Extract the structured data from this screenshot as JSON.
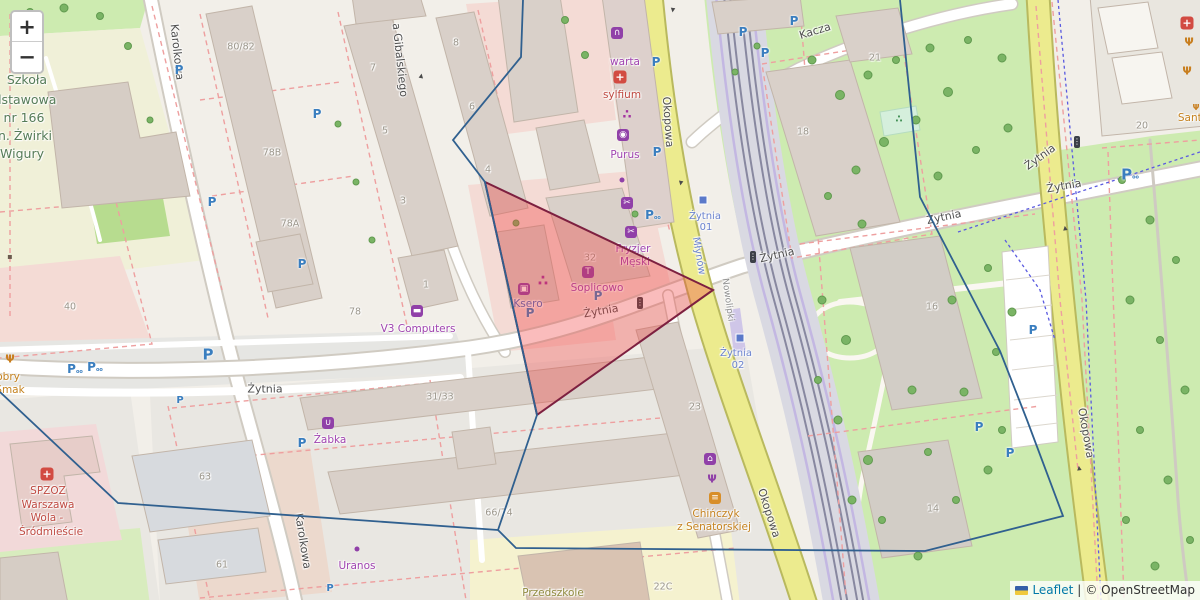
{
  "attribution": {
    "leaflet": "Leaflet",
    "separator": "|",
    "osm": "© OpenStreetMap"
  },
  "zoom_control": {
    "zoom_in": "+",
    "zoom_out": "−"
  },
  "colors": {
    "triangle_fill": "#ef3b3b",
    "triangle_stroke": "#7d2040",
    "boundary_stroke": "#30608f",
    "shop_purple": "#a044b0",
    "transit_blue": "#6b83cf",
    "road_yellow": "#eceb8e",
    "park_green": "#cdebb0"
  },
  "overlays": {
    "red_triangle": {
      "points": "485,182 713,290 537,415",
      "fill": "#ef3b3b",
      "fill_opacity": 0.34,
      "stroke": "#7d2040",
      "stroke_width": 2
    },
    "blue_boundary": {
      "stroke": "#30608f",
      "stroke_width": 1.8,
      "paths": [
        "523,0 521,57 453,140 485,182 537,415 498,530",
        "0,392 118,503 498,530",
        "498,530 516,548 925,551 1063,516 1027,420 1000,351 920,197 900,0"
      ]
    }
  },
  "labels": [
    {
      "t": "Żytnia",
      "x": 265,
      "y": 389,
      "c": "street",
      "n": "street-label-zytnia"
    },
    {
      "t": "Żytnia",
      "x": 601,
      "y": 311,
      "c": "street",
      "r": -10,
      "n": "street-label-zytnia"
    },
    {
      "t": "Żytnia",
      "x": 777,
      "y": 255,
      "c": "street",
      "r": -13,
      "n": "street-label-zytnia"
    },
    {
      "t": "Żytnia",
      "x": 944,
      "y": 217,
      "c": "street",
      "r": -12,
      "n": "street-label-zytnia"
    },
    {
      "t": "Żytnia",
      "x": 1040,
      "y": 157,
      "c": "street",
      "r": -36,
      "n": "street-label-zytnia"
    },
    {
      "t": "Żytnia",
      "x": 1064,
      "y": 186,
      "c": "street",
      "r": -10,
      "n": "street-label-zytnia"
    },
    {
      "t": "Kacza",
      "x": 815,
      "y": 31,
      "c": "street",
      "r": -17,
      "n": "street-label-kacza"
    },
    {
      "t": "Karolkowa",
      "x": 177,
      "y": 52,
      "c": "street",
      "r": 84,
      "n": "street-label-karolkowa"
    },
    {
      "t": "Karolkowa",
      "x": 303,
      "y": 541,
      "c": "street",
      "r": 81,
      "n": "street-label-karolkowa"
    },
    {
      "t": "a Gibalskiego",
      "x": 400,
      "y": 60,
      "c": "street",
      "r": 84,
      "n": "street-label-gibalskiego"
    },
    {
      "t": "Okopowa",
      "x": 668,
      "y": 122,
      "c": "street",
      "r": 86,
      "n": "street-label-okopowa"
    },
    {
      "t": "Okopowa",
      "x": 769,
      "y": 513,
      "c": "street",
      "r": 72,
      "n": "street-label-okopowa"
    },
    {
      "t": "Okopowa",
      "x": 1086,
      "y": 433,
      "c": "street",
      "r": 80,
      "n": "street-label-okopowa"
    },
    {
      "t": "Nowolipki",
      "x": 727,
      "y": 300,
      "c": "street-sm",
      "r": 82,
      "n": "street-label-nowolipki"
    },
    {
      "t": "Młynów",
      "x": 698,
      "y": 256,
      "c": "transit",
      "r": 80,
      "n": "transit-label-mlynow"
    },
    {
      "t": "Żytnia",
      "x": 705,
      "y": 217,
      "c": "transit",
      "n": "transit-stop-label"
    },
    {
      "t": "01",
      "x": 706,
      "y": 228,
      "c": "transit",
      "n": "transit-stop-label"
    },
    {
      "t": "Żytnia",
      "x": 736,
      "y": 354,
      "c": "transit",
      "n": "transit-stop-label"
    },
    {
      "t": "02",
      "x": 738,
      "y": 366,
      "c": "transit",
      "n": "transit-stop-label"
    },
    {
      "t": "Szkoła",
      "x": 27,
      "y": 80,
      "c": "school",
      "n": "school-label"
    },
    {
      "t": "dstawowa",
      "x": 25,
      "y": 100,
      "c": "school",
      "n": "school-label"
    },
    {
      "t": "nr 166",
      "x": 24,
      "y": 118,
      "c": "school",
      "n": "school-label"
    },
    {
      "t": "n. Żwirki",
      "x": 25,
      "y": 136,
      "c": "school",
      "n": "school-label"
    },
    {
      "t": "Wigury",
      "x": 22,
      "y": 154,
      "c": "school",
      "n": "school-label"
    },
    {
      "t": "warta",
      "x": 625,
      "y": 62,
      "c": "shop",
      "n": "poi-label-warta"
    },
    {
      "t": "sylfium",
      "x": 622,
      "y": 95,
      "c": "health",
      "n": "poi-label-sylfium"
    },
    {
      "t": "Purus",
      "x": 625,
      "y": 155,
      "c": "shop",
      "n": "poi-label-purus"
    },
    {
      "t": "Fryzjer",
      "x": 633,
      "y": 249,
      "c": "shop",
      "n": "poi-label-fryzjer"
    },
    {
      "t": "Męski",
      "x": 635,
      "y": 262,
      "c": "shop",
      "n": "poi-label-fryzjer"
    },
    {
      "t": "Soplicowo",
      "x": 597,
      "y": 288,
      "c": "shop",
      "n": "poi-label-soplicowo"
    },
    {
      "t": "Ksero",
      "x": 528,
      "y": 304,
      "c": "office",
      "n": "poi-label-ksero"
    },
    {
      "t": "V3 Computers",
      "x": 418,
      "y": 329,
      "c": "shop",
      "n": "poi-label-v3-computers"
    },
    {
      "t": "Żabka",
      "x": 330,
      "y": 440,
      "c": "shop",
      "n": "poi-label-zabka"
    },
    {
      "t": "Uranos",
      "x": 357,
      "y": 566,
      "c": "shop",
      "n": "poi-label-uranos"
    },
    {
      "t": "Chińczyk",
      "x": 716,
      "y": 514,
      "c": "food",
      "n": "poi-label-chinczyk"
    },
    {
      "t": "z Senatorskiej",
      "x": 714,
      "y": 527,
      "c": "food",
      "n": "poi-label-chinczyk"
    },
    {
      "t": "Dobry",
      "x": 4,
      "y": 377,
      "c": "food",
      "n": "poi-label-dobry-smak"
    },
    {
      "t": "Smak",
      "x": 10,
      "y": 390,
      "c": "food",
      "n": "poi-label-dobry-smak"
    },
    {
      "t": "SPZOZ",
      "x": 48,
      "y": 491,
      "c": "health",
      "n": "poi-label-spzoz"
    },
    {
      "t": "Warszawa",
      "x": 48,
      "y": 505,
      "c": "health",
      "n": "poi-label-spzoz"
    },
    {
      "t": "Wola -",
      "x": 47,
      "y": 518,
      "c": "health",
      "n": "poi-label-spzoz"
    },
    {
      "t": "Śródmieście",
      "x": 51,
      "y": 532,
      "c": "health",
      "n": "poi-label-spzoz"
    },
    {
      "t": "Przedszkole",
      "x": 553,
      "y": 593,
      "c": "kindergarten",
      "n": "poi-label-przedszkole"
    },
    {
      "t": "Santa",
      "x": 1193,
      "y": 118,
      "c": "food",
      "n": "poi-label-santa"
    },
    {
      "t": "80/82",
      "x": 241,
      "y": 47,
      "c": "housenum"
    },
    {
      "t": "78B",
      "x": 272,
      "y": 153,
      "c": "housenum"
    },
    {
      "t": "78A",
      "x": 290,
      "y": 224,
      "c": "housenum"
    },
    {
      "t": "78",
      "x": 355,
      "y": 312,
      "c": "housenum"
    },
    {
      "t": "40",
      "x": 70,
      "y": 307,
      "c": "housenum"
    },
    {
      "t": "63",
      "x": 205,
      "y": 477,
      "c": "housenum"
    },
    {
      "t": "61",
      "x": 222,
      "y": 565,
      "c": "housenum"
    },
    {
      "t": "8",
      "x": 456,
      "y": 43,
      "c": "housenum"
    },
    {
      "t": "7",
      "x": 373,
      "y": 68,
      "c": "housenum"
    },
    {
      "t": "6",
      "x": 472,
      "y": 107,
      "c": "housenum"
    },
    {
      "t": "5",
      "x": 385,
      "y": 131,
      "c": "housenum"
    },
    {
      "t": "4",
      "x": 488,
      "y": 170,
      "c": "housenum"
    },
    {
      "t": "3",
      "x": 403,
      "y": 201,
      "c": "housenum"
    },
    {
      "t": "1",
      "x": 426,
      "y": 285,
      "c": "housenum"
    },
    {
      "t": "32",
      "x": 590,
      "y": 258,
      "c": "housenum"
    },
    {
      "t": "31/33",
      "x": 440,
      "y": 397,
      "c": "housenum"
    },
    {
      "t": "66/74",
      "x": 499,
      "y": 513,
      "c": "housenum"
    },
    {
      "t": "23",
      "x": 695,
      "y": 407,
      "c": "housenum"
    },
    {
      "t": "22C",
      "x": 663,
      "y": 587,
      "c": "housenum"
    },
    {
      "t": "18",
      "x": 803,
      "y": 132,
      "c": "housenum"
    },
    {
      "t": "21",
      "x": 875,
      "y": 58,
      "c": "housenum"
    },
    {
      "t": "16",
      "x": 932,
      "y": 307,
      "c": "housenum"
    },
    {
      "t": "14",
      "x": 933,
      "y": 509,
      "c": "housenum"
    },
    {
      "t": "20",
      "x": 1142,
      "y": 126,
      "c": "housenum"
    }
  ],
  "icon_glyphs": {
    "parking": "P",
    "parking-bike": "P",
    "firstaid": "+",
    "cutlery": "Ψ",
    "awning": "∩",
    "paw": "∴",
    "washing": "◉",
    "scissors": "✂",
    "shirt": "T",
    "copy": "▣",
    "laptop": "▬",
    "basket": "∪",
    "restaurant": "Ψ",
    "factory": "⌂",
    "burger": "≡",
    "trafficlight": "⋮",
    "playground": "∴",
    "oneway": "▸",
    "poi-dark": "▪"
  },
  "icons": [
    {
      "type": "parking",
      "x": 179,
      "y": 70
    },
    {
      "type": "parking",
      "x": 212,
      "y": 202
    },
    {
      "type": "parking",
      "x": 317,
      "y": 114
    },
    {
      "type": "parking",
      "x": 302,
      "y": 264
    },
    {
      "type": "parking",
      "x": 530,
      "y": 313
    },
    {
      "type": "parking",
      "x": 598,
      "y": 296
    },
    {
      "type": "parking",
      "x": 656,
      "y": 62
    },
    {
      "type": "parking",
      "x": 657,
      "y": 152
    },
    {
      "type": "parking",
      "x": 743,
      "y": 32
    },
    {
      "type": "parking",
      "x": 794,
      "y": 21
    },
    {
      "type": "parking",
      "x": 765,
      "y": 53
    },
    {
      "type": "parking",
      "x": 208,
      "y": 355,
      "s": 15
    },
    {
      "type": "parking",
      "x": 180,
      "y": 401,
      "s": 10
    },
    {
      "type": "parking",
      "x": 302,
      "y": 443
    },
    {
      "type": "parking",
      "x": 330,
      "y": 589,
      "s": 10
    },
    {
      "type": "parking",
      "x": 979,
      "y": 427
    },
    {
      "type": "parking",
      "x": 1010,
      "y": 453
    },
    {
      "type": "parking",
      "x": 1033,
      "y": 330
    },
    {
      "type": "parking-bike",
      "x": 75,
      "y": 369
    },
    {
      "type": "parking-bike",
      "x": 95,
      "y": 367
    },
    {
      "type": "parking-bike",
      "x": 653,
      "y": 215
    },
    {
      "type": "parking-bike",
      "x": 1130,
      "y": 175,
      "s": 15
    },
    {
      "type": "firstaid",
      "x": 620,
      "y": 77
    },
    {
      "type": "firstaid",
      "x": 47,
      "y": 474
    },
    {
      "type": "firstaid",
      "x": 1187,
      "y": 23
    },
    {
      "type": "cutlery",
      "x": 10,
      "y": 359
    },
    {
      "type": "cutlery",
      "x": 1189,
      "y": 42
    },
    {
      "type": "cutlery",
      "x": 1187,
      "y": 71
    },
    {
      "type": "cutlery",
      "x": 1196,
      "y": 108,
      "s": 8
    },
    {
      "type": "awning",
      "x": 617,
      "y": 33
    },
    {
      "type": "paw",
      "x": 627,
      "y": 115
    },
    {
      "type": "paw",
      "x": 543,
      "y": 281,
      "s": 15
    },
    {
      "type": "washing",
      "x": 623,
      "y": 135
    },
    {
      "type": "scissors",
      "x": 627,
      "y": 203
    },
    {
      "type": "scissors",
      "x": 631,
      "y": 232
    },
    {
      "type": "shirt",
      "x": 588,
      "y": 272
    },
    {
      "type": "copy",
      "x": 524,
      "y": 289
    },
    {
      "type": "laptop",
      "x": 417,
      "y": 311
    },
    {
      "type": "basket",
      "x": 328,
      "y": 423
    },
    {
      "type": "restaurant",
      "x": 712,
      "y": 479
    },
    {
      "type": "factory",
      "x": 710,
      "y": 459
    },
    {
      "type": "burger",
      "x": 715,
      "y": 498
    },
    {
      "type": "dot",
      "x": 622,
      "y": 180
    },
    {
      "type": "dot",
      "x": 357,
      "y": 549
    },
    {
      "type": "poi-dark",
      "x": 10,
      "y": 257
    },
    {
      "type": "trafficlight",
      "x": 640,
      "y": 303
    },
    {
      "type": "trafficlight",
      "x": 753,
      "y": 257
    },
    {
      "type": "trafficlight",
      "x": 1077,
      "y": 142
    },
    {
      "type": "stopsq",
      "x": 703,
      "y": 200
    },
    {
      "type": "stopsq",
      "x": 740,
      "y": 338
    },
    {
      "type": "playground",
      "x": 899,
      "y": 120
    },
    {
      "type": "oneway",
      "x": 672,
      "y": 10,
      "r": 97
    },
    {
      "type": "oneway",
      "x": 680,
      "y": 183,
      "r": 100
    },
    {
      "type": "oneway",
      "x": 1066,
      "y": 228,
      "r": 262
    },
    {
      "type": "oneway",
      "x": 1080,
      "y": 468,
      "r": 262
    },
    {
      "type": "oneway",
      "x": 422,
      "y": 76,
      "r": -80
    }
  ],
  "trees": [
    [
      812,
      60,
      9
    ],
    [
      840,
      95,
      10
    ],
    [
      868,
      75,
      9
    ],
    [
      896,
      60,
      8
    ],
    [
      930,
      48,
      9
    ],
    [
      968,
      40,
      8
    ],
    [
      1002,
      58,
      9
    ],
    [
      948,
      92,
      10
    ],
    [
      916,
      120,
      9
    ],
    [
      884,
      142,
      10
    ],
    [
      856,
      170,
      9
    ],
    [
      828,
      196,
      8
    ],
    [
      862,
      224,
      9
    ],
    [
      938,
      176,
      9
    ],
    [
      976,
      150,
      8
    ],
    [
      1008,
      128,
      9
    ],
    [
      822,
      300,
      9
    ],
    [
      846,
      340,
      10
    ],
    [
      818,
      380,
      8
    ],
    [
      838,
      420,
      9
    ],
    [
      868,
      460,
      10
    ],
    [
      852,
      500,
      9
    ],
    [
      882,
      520,
      8
    ],
    [
      918,
      556,
      9
    ],
    [
      956,
      500,
      8
    ],
    [
      988,
      470,
      9
    ],
    [
      1002,
      430,
      8
    ],
    [
      964,
      392,
      9
    ],
    [
      996,
      352,
      8
    ],
    [
      1012,
      312,
      9
    ],
    [
      988,
      268,
      8
    ],
    [
      952,
      300,
      9
    ],
    [
      912,
      390,
      9
    ],
    [
      928,
      452,
      8
    ],
    [
      1122,
      180,
      8
    ],
    [
      1150,
      220,
      9
    ],
    [
      1176,
      260,
      8
    ],
    [
      1130,
      300,
      9
    ],
    [
      1160,
      340,
      8
    ],
    [
      1185,
      390,
      9
    ],
    [
      1140,
      430,
      8
    ],
    [
      1168,
      480,
      9
    ],
    [
      1126,
      520,
      8
    ],
    [
      1155,
      566,
      9
    ],
    [
      1190,
      540,
      8
    ],
    [
      30,
      12,
      8
    ],
    [
      64,
      8,
      9
    ],
    [
      100,
      16,
      8
    ],
    [
      128,
      46,
      8
    ],
    [
      150,
      120,
      7
    ],
    [
      338,
      124,
      7
    ],
    [
      356,
      182,
      7
    ],
    [
      372,
      240,
      7
    ],
    [
      565,
      20,
      8
    ],
    [
      585,
      55,
      8
    ],
    [
      516,
      223,
      7
    ],
    [
      635,
      214,
      7
    ],
    [
      757,
      46,
      7
    ],
    [
      735,
      72,
      7
    ]
  ]
}
